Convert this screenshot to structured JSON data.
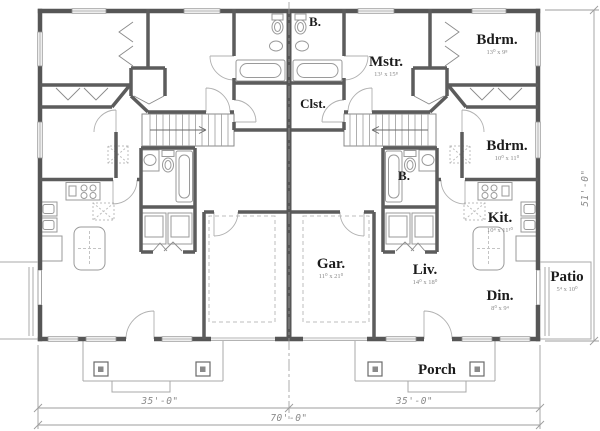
{
  "plan": {
    "rooms": {
      "bath_upper": {
        "label": "B."
      },
      "master": {
        "label": "Mstr.",
        "dims": "13¹ x 15⁸"
      },
      "bedroom_upper": {
        "label": "Bdrm.",
        "dims": "13⁰ x 9⁸"
      },
      "closet": {
        "label": "Clst."
      },
      "bedroom_right": {
        "label": "Bdrm.",
        "dims": "10⁰ x 11⁰"
      },
      "bath_lower": {
        "label": "B."
      },
      "kitchen": {
        "label": "Kit.",
        "dims": "10⁴ x 11¹⁰"
      },
      "garage": {
        "label": "Gar.",
        "dims": "11⁰ x 21⁰"
      },
      "living": {
        "label": "Liv.",
        "dims": "14⁰ x 18⁰"
      },
      "patio": {
        "label": "Patio",
        "dims": "5⁴ x 10⁰"
      },
      "dining": {
        "label": "Din.",
        "dims": "8⁰ x 9⁴"
      },
      "porch": {
        "label": "Porch"
      }
    },
    "dimensions": {
      "left_unit_width": "35'-0\"",
      "right_unit_width": "35'-0\"",
      "total_width": "70'-0\"",
      "overall_depth": "51'-0\""
    },
    "colors": {
      "wall": "#565656",
      "fixture": "#9a9a9a",
      "dimension": "#8c8c8c",
      "background": "#ffffff"
    }
  }
}
